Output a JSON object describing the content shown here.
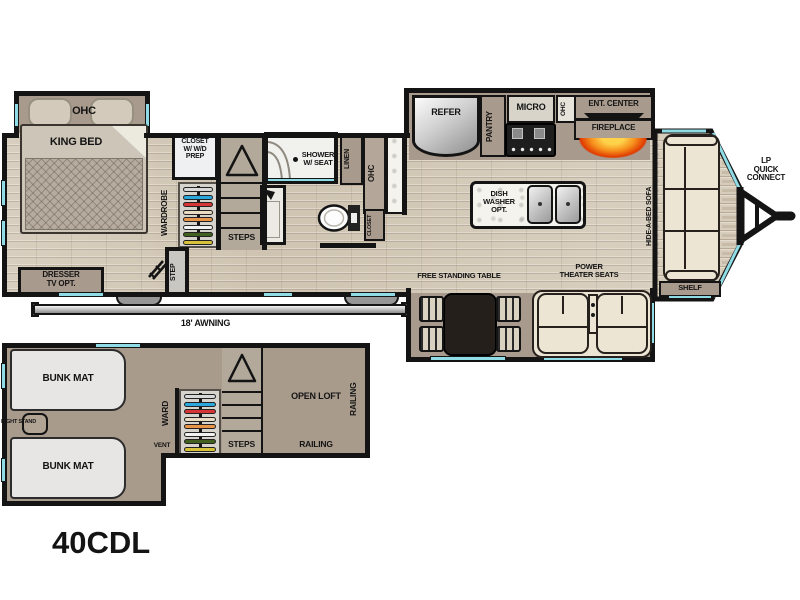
{
  "model": "40CDL",
  "colors": {
    "wall": "#141414",
    "window": "#8fdbe6",
    "floor_base": "#d6cdbd",
    "cabinet": "#a89a8c",
    "flame": [
      "#ffd24a",
      "#f6921e",
      "#e03a00"
    ],
    "hangers": [
      "#d8d8d8",
      "#2aa7dd",
      "#d63535",
      "#e9dcc2",
      "#e8954a",
      "#f2f2f2",
      "#42601f",
      "#d8c23a"
    ]
  },
  "main_floor": {
    "bedroom": {
      "ohc": "OHC",
      "king_bed": "KING BED",
      "wardrobe": "WARDROBE",
      "closet_wd": "CLOSET\nW/ W/D\nPREP",
      "steps": "STEPS",
      "entry_step": "STEP",
      "dresser": "DRESSER\nTV OPT."
    },
    "bathroom": {
      "shower": "SHOWER\nW/ SEAT",
      "linen": "LINEN",
      "ohc": "OHC",
      "closet": "CLOSET"
    },
    "kitchen": {
      "refer": "REFER",
      "pantry": "PANTRY",
      "micro": "MICRO",
      "ohc": "OHC",
      "ent_center": "ENT. CENTER",
      "fireplace": "FIREPLACE",
      "dishwasher": "DISH\nWASHER\nOPT."
    },
    "living": {
      "sofa": "HIDE-A-BED SOFA",
      "shelf": "SHELF",
      "table": "FREE STANDING TABLE",
      "theater_seats": "POWER\nTHEATER SEATS",
      "lp_connect": "LP\nQUICK\nCONNECT"
    },
    "awning": "18' AWNING"
  },
  "loft": {
    "bunk_top": "BUNK MAT",
    "bunk_bottom": "BUNK MAT",
    "night_stand": "NIGHT STAND",
    "ward": "WARD",
    "vent": "VENT",
    "steps": "STEPS",
    "open_loft": "OPEN LOFT",
    "railing_bottom": "RAILING",
    "railing_side": "RAILING"
  }
}
